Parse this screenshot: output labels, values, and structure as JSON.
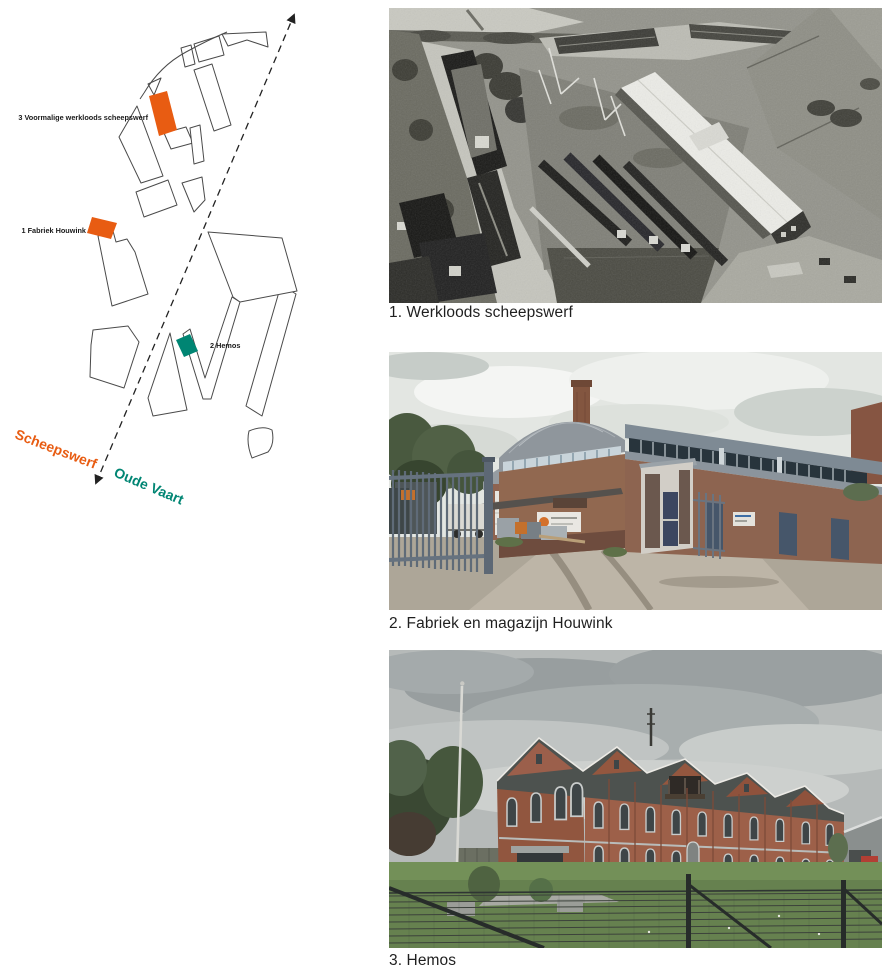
{
  "map": {
    "labels": {
      "building3": "3 Voormalige werkloods scheepswerf",
      "building1": "1 Fabriek Houwink",
      "building2": "2 Hemos",
      "street": "Scheepswerf",
      "canal": "Oude Vaart"
    },
    "colors": {
      "orange": "#E85C12",
      "teal": "#008573",
      "outline": "#4A4A4A",
      "label": "#1A1A1A",
      "arrow": "#222222"
    }
  },
  "photos": [
    {
      "caption": "1. Werkloods scheepswerf"
    },
    {
      "caption": "2. Fabriek en magazijn Houwink"
    },
    {
      "caption": "3. Hemos"
    }
  ]
}
